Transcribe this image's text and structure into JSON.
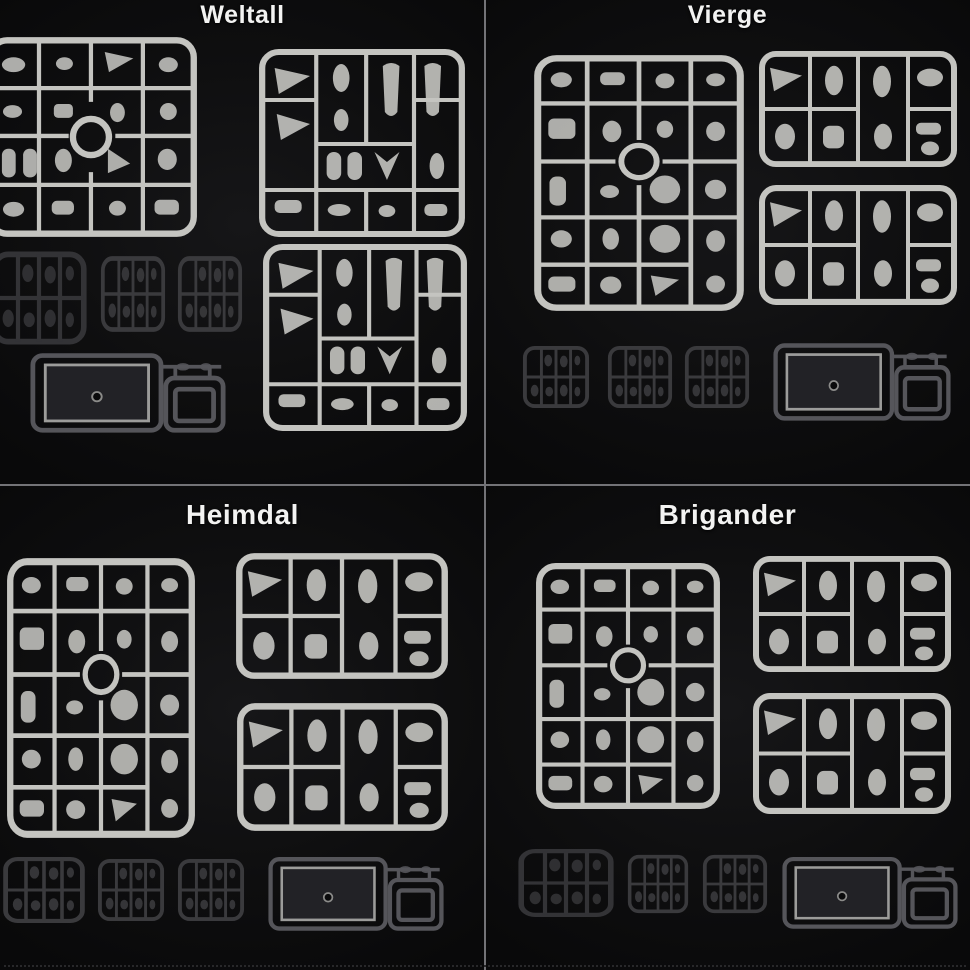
{
  "page": {
    "description": "Four-panel black product photo comparing unassembled plastic model kit runners",
    "background_color": "#0a0a0b",
    "divider_color": "#737377",
    "title_color": "#f3f3f2"
  },
  "colors": {
    "light_runner": "#c4c4c0",
    "clear_dark_runner": "#3a3a3d",
    "base_runner_frame": "#55555a",
    "base_plate_border": "#9c9c9a",
    "base_plate_fill": "#222226"
  },
  "quadrants": [
    {
      "id": "weltall",
      "title": "Weltall",
      "position": "top-left",
      "runners": {
        "light_gray": 3,
        "dark_clear": 3,
        "display_base": 1
      }
    },
    {
      "id": "vierge",
      "title": "Vierge",
      "position": "top-right",
      "runners": {
        "light_gray": 3,
        "dark_clear": 3,
        "display_base": 1
      }
    },
    {
      "id": "heimdal",
      "title": "Heimdal",
      "position": "bottom-left",
      "runners": {
        "light_gray": 3,
        "dark_clear": 3,
        "display_base": 1
      }
    },
    {
      "id": "brigander",
      "title": "Brigander",
      "position": "bottom-right",
      "runners": {
        "light_gray": 3,
        "dark_clear": 3,
        "display_base": 1
      }
    }
  ]
}
